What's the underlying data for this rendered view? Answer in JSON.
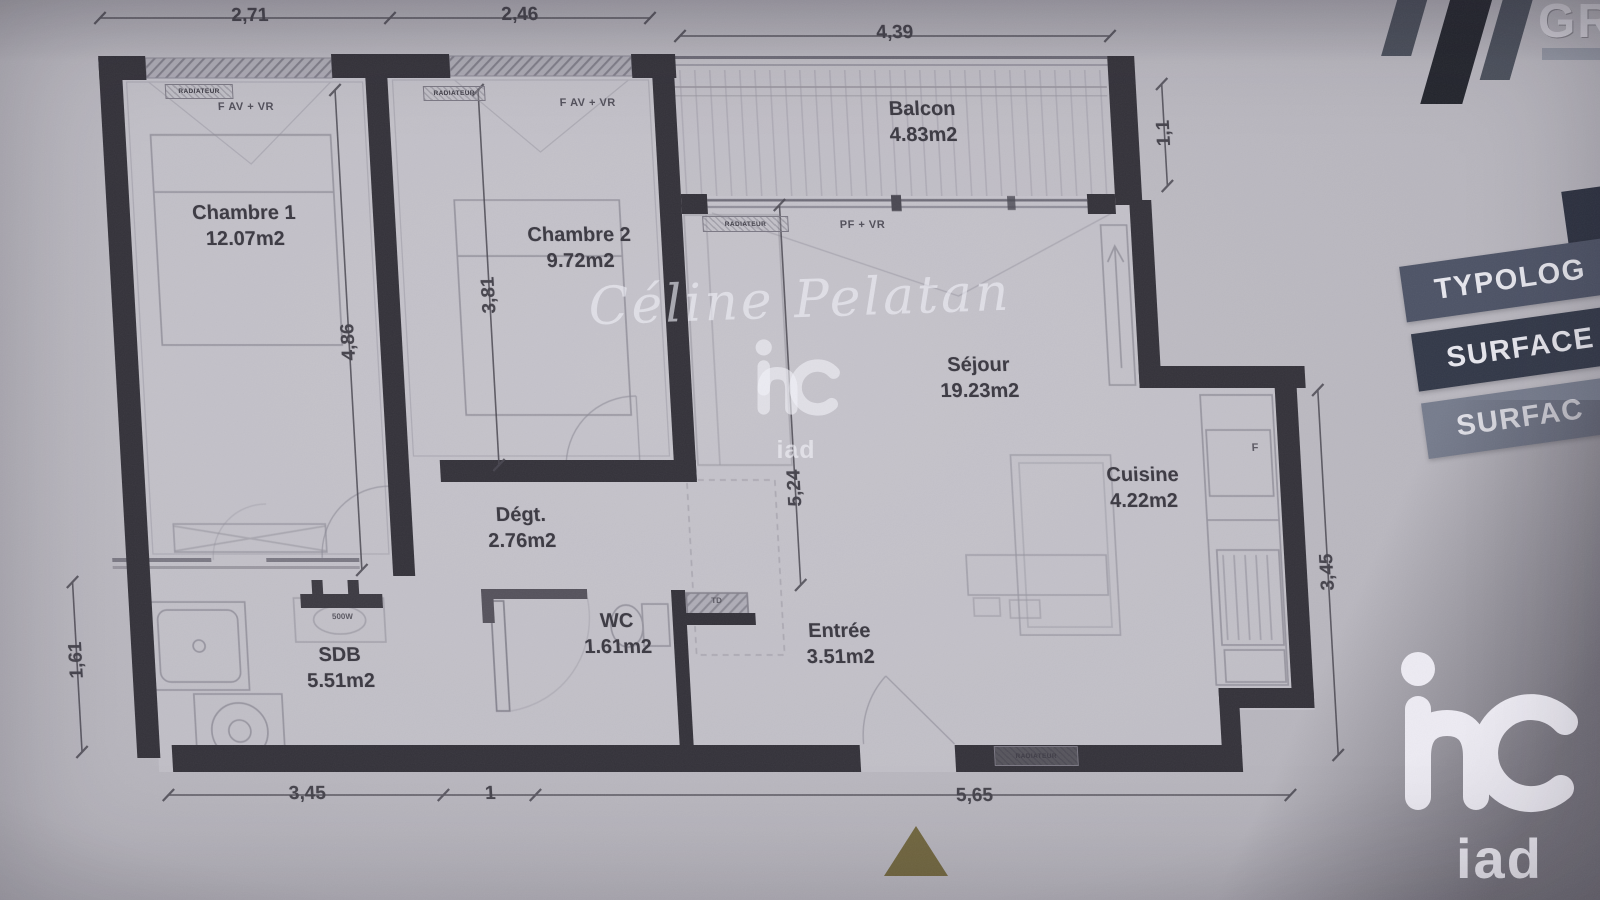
{
  "plan": {
    "rooms": [
      {
        "name": "Chambre 1",
        "area": "12.07m2"
      },
      {
        "name": "Chambre 2",
        "area": "9.72m2"
      },
      {
        "name": "Balcon",
        "area": "4.83m2"
      },
      {
        "name": "Séjour",
        "area": "19.23m2"
      },
      {
        "name": "Cuisine",
        "area": "4.22m2"
      },
      {
        "name": "Dégt.",
        "area": "2.76m2"
      },
      {
        "name": "WC",
        "area": "1.61m2"
      },
      {
        "name": "SDB",
        "area": "5.51m2"
      },
      {
        "name": "Entrée",
        "area": "3.51m2"
      }
    ],
    "dims": {
      "top_left": "2,71",
      "top_mid": "2,46",
      "top_right": "4,39",
      "balcony_depth": "1,1",
      "right_side": "3,45",
      "left_side": "1,61",
      "bottom_left": "3,45",
      "bottom_mid": "1",
      "bottom_right": "5,65",
      "chambre1_height": "4,86",
      "chambre2_height": "3,81",
      "sejour_height": "5,24"
    },
    "labels": {
      "window_chambre1": "F AV + VR",
      "window_chambre2": "F AV + VR",
      "bay_window": "PF + VR",
      "radiator_chambre1": "RADIATEUR",
      "radiator_chambre2": "RADIATEUR",
      "radiator_sejour": "RADIATEUR",
      "radiator_entree": "RADIATEUR",
      "towel_radiator_power": "500W",
      "fridge": "F",
      "duct": "TD"
    }
  },
  "watermark": {
    "signature": "Céline Pelatan",
    "brand": "iad"
  },
  "overlays": {
    "corner_brand_fragment": "GR",
    "side_banners": [
      {
        "label": "TYPOLOG"
      },
      {
        "label": "SURFACE"
      },
      {
        "label": "SURFAC"
      }
    ],
    "agency_logo_text": "iad"
  },
  "colors": {
    "wall": "#34323a",
    "paper": "#bfbdc5",
    "banner_dark": "#323848",
    "banner_mid": "#4d5366",
    "banner_light": "#767c8d",
    "north_triangle": "#6b6134",
    "logo_white": "#edebf3"
  }
}
